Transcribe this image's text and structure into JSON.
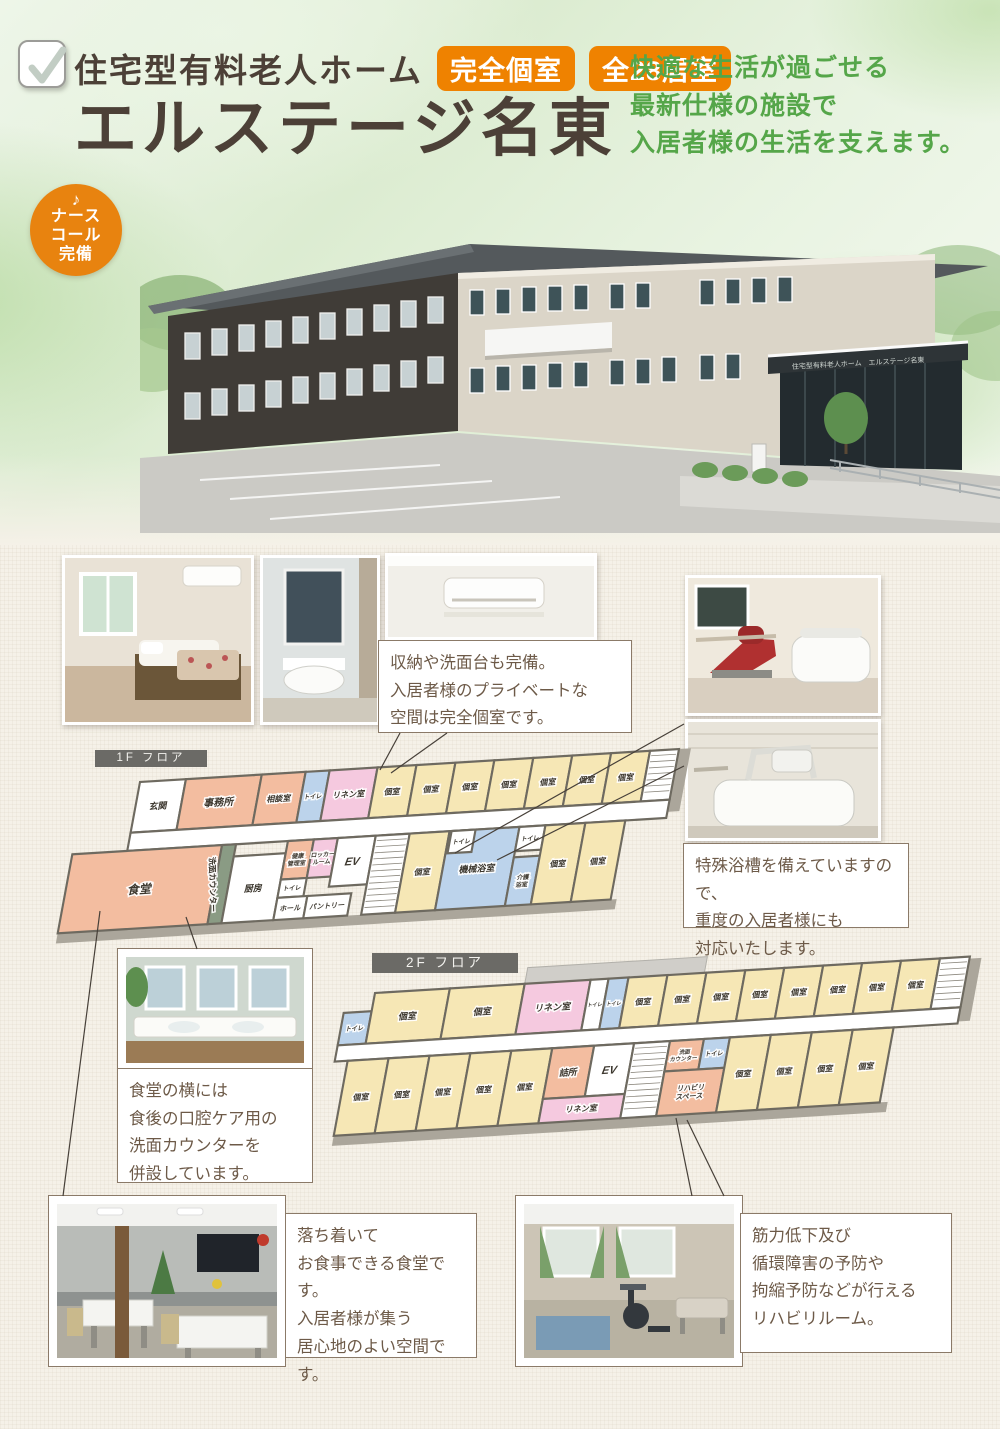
{
  "header": {
    "category": "住宅型有料老人ホーム",
    "badge1": "完全個室",
    "badge2": "全28居室",
    "title": "エルステージ名東",
    "tagline": [
      "快適な生活が過ごせる",
      "最新仕様の施設で",
      "入居者様の生活を支えます。"
    ],
    "nurse_note": "♪",
    "nurse_lines": [
      "ナース",
      "コール",
      "完備"
    ]
  },
  "building": {
    "sign": "住宅型有料老人ホーム　エルステージ名東"
  },
  "callouts": {
    "private_room": [
      "収納や洗面台も完備。",
      "入居者様のプライベートな",
      "空間は完全個室です。"
    ],
    "special_bath": [
      "特殊浴槽を備えていますので、",
      "重度の入居者様にも",
      "対応いたします。"
    ],
    "wash_counter": [
      "食堂の横には",
      "食後の口腔ケア用の",
      "洗面カウンターを",
      "併設しています。"
    ],
    "dining": [
      "落ち着いて",
      "お食事できる食堂です。",
      "入居者様が集う",
      "居心地のよい空間です。"
    ],
    "rehab": [
      "筋力低下及び",
      "循環障害の予防や",
      "拘縮予防などが行える",
      "リハビリルーム。"
    ]
  },
  "floors": [
    {
      "label": "1F フロア",
      "shadows": [
        {
          "x": -55,
          "y": 146,
          "w": 560,
          "h": 10
        },
        {
          "x": 540,
          "y": 0,
          "w": 12,
          "h": 62
        }
      ],
      "rooms": [
        {
          "label": "玄関",
          "x": 0,
          "y": 0,
          "w": 46,
          "h": 50,
          "f": "white",
          "fs": 9
        },
        {
          "label": "事務所",
          "x": 46,
          "y": 0,
          "w": 76,
          "h": 50,
          "f": "salmon",
          "fs": 10
        },
        {
          "label": "相談室",
          "x": 122,
          "y": 0,
          "w": 44,
          "h": 50,
          "f": "salmon",
          "fs": 8
        },
        {
          "label": "トイレ",
          "x": 166,
          "y": 0,
          "w": 24,
          "h": 50,
          "f": "blue",
          "fs": 6
        },
        {
          "label": "リネン室",
          "x": 190,
          "y": 0,
          "w": 48,
          "h": 50,
          "f": "pink",
          "fs": 8
        },
        {
          "label": "個室",
          "x": 238,
          "y": 0,
          "w": 39,
          "h": 50,
          "f": "cream",
          "fs": 8
        },
        {
          "label": "個室",
          "x": 277,
          "y": 0,
          "w": 39,
          "h": 50,
          "f": "cream",
          "fs": 8
        },
        {
          "label": "個室",
          "x": 316,
          "y": 0,
          "w": 39,
          "h": 50,
          "f": "cream",
          "fs": 8
        },
        {
          "label": "個室",
          "x": 355,
          "y": 0,
          "w": 39,
          "h": 50,
          "f": "cream",
          "fs": 8
        },
        {
          "label": "個室",
          "x": 394,
          "y": 0,
          "w": 39,
          "h": 50,
          "f": "cream",
          "fs": 8
        },
        {
          "label": "個室",
          "x": 433,
          "y": 0,
          "w": 39,
          "h": 50,
          "f": "cream",
          "fs": 8
        },
        {
          "label": "個室",
          "x": 472,
          "y": 0,
          "w": 39,
          "h": 50,
          "f": "cream",
          "fs": 8
        },
        {
          "label": "",
          "x": 511,
          "y": 0,
          "w": 29,
          "h": 50,
          "f": "stairs"
        },
        {
          "label": "",
          "x": 0,
          "y": 50,
          "w": 540,
          "h": 18,
          "f": "white"
        },
        {
          "label": "食堂",
          "x": -55,
          "y": 68,
          "w": 150,
          "h": 78,
          "f": "salmon",
          "fs": 12
        },
        {
          "label": "洗面カウンター",
          "x": 95,
          "y": 68,
          "w": 14,
          "h": 78,
          "f": "green",
          "fs": 8,
          "vert": true
        },
        {
          "label": "厨房",
          "x": 109,
          "y": 80,
          "w": 52,
          "h": 66,
          "f": "white",
          "fs": 9
        },
        {
          "label": "健康\n管理室",
          "x": 161,
          "y": 68,
          "w": 26,
          "h": 38,
          "f": "salmon",
          "fs": 6
        },
        {
          "label": "ロッカー\nルーム",
          "x": 187,
          "y": 68,
          "w": 24,
          "h": 38,
          "f": "pink",
          "fs": 6
        },
        {
          "label": "EV",
          "x": 211,
          "y": 68,
          "w": 38,
          "h": 48,
          "f": "white",
          "fs": 11
        },
        {
          "label": "トイレ",
          "x": 161,
          "y": 106,
          "w": 26,
          "h": 18,
          "f": "white",
          "fs": 6
        },
        {
          "label": "ホール",
          "x": 161,
          "y": 124,
          "w": 30,
          "h": 22,
          "f": "white",
          "fs": 7
        },
        {
          "label": "パントリー",
          "x": 191,
          "y": 124,
          "w": 44,
          "h": 22,
          "f": "white",
          "fs": 7
        },
        {
          "label": "",
          "x": 249,
          "y": 68,
          "w": 34,
          "h": 78,
          "f": "stairs"
        },
        {
          "label": "個室",
          "x": 283,
          "y": 68,
          "w": 40,
          "h": 78,
          "f": "cream",
          "fs": 8
        },
        {
          "label": "機械浴室",
          "x": 323,
          "y": 68,
          "w": 70,
          "h": 78,
          "f": "blue",
          "fs": 9
        },
        {
          "label": "トイレ",
          "x": 325,
          "y": 68,
          "w": 24,
          "h": 22,
          "f": "white",
          "fs": 6
        },
        {
          "label": "トイレ",
          "x": 393,
          "y": 68,
          "w": 26,
          "h": 24,
          "f": "white",
          "fs": 6
        },
        {
          "label": "介護\n浴室",
          "x": 393,
          "y": 98,
          "w": 26,
          "h": 48,
          "f": "blue",
          "fs": 6
        },
        {
          "label": "個室",
          "x": 419,
          "y": 68,
          "w": 40,
          "h": 78,
          "f": "cream",
          "fs": 8
        },
        {
          "label": "個室",
          "x": 459,
          "y": 68,
          "w": 40,
          "h": 78,
          "f": "cream",
          "fs": 8
        }
      ]
    },
    {
      "label": "2F フロア",
      "shadows": [
        {
          "x": -15,
          "y": 140,
          "w": 555,
          "h": 10
        },
        {
          "x": 596,
          "y": 2,
          "w": 12,
          "h": 62
        }
      ],
      "rooms": [
        {
          "label": "",
          "x": 150,
          "y": -16,
          "w": 180,
          "h": 16,
          "f": "balcony"
        },
        {
          "label": "トイレ",
          "x": -28,
          "y": 18,
          "w": 28,
          "h": 32,
          "f": "blue",
          "fs": 6
        },
        {
          "label": "個室",
          "x": 0,
          "y": 0,
          "w": 75,
          "h": 50,
          "f": "cream",
          "fs": 9
        },
        {
          "label": "個室",
          "x": 75,
          "y": 0,
          "w": 75,
          "h": 50,
          "f": "cream",
          "fs": 9
        },
        {
          "label": "リネン室",
          "x": 150,
          "y": 0,
          "w": 66,
          "h": 50,
          "f": "pink",
          "fs": 9
        },
        {
          "label": "トイレ",
          "x": 216,
          "y": 0,
          "w": 18,
          "h": 50,
          "f": "white",
          "fs": 5
        },
        {
          "label": "トイレ",
          "x": 234,
          "y": 0,
          "w": 20,
          "h": 50,
          "f": "blue",
          "fs": 5
        },
        {
          "label": "個室",
          "x": 254,
          "y": 0,
          "w": 39,
          "h": 50,
          "f": "cream",
          "fs": 8
        },
        {
          "label": "個室",
          "x": 293,
          "y": 0,
          "w": 39,
          "h": 50,
          "f": "cream",
          "fs": 8
        },
        {
          "label": "個室",
          "x": 332,
          "y": 0,
          "w": 39,
          "h": 50,
          "f": "cream",
          "fs": 8
        },
        {
          "label": "個室",
          "x": 371,
          "y": 0,
          "w": 39,
          "h": 50,
          "f": "cream",
          "fs": 8
        },
        {
          "label": "個室",
          "x": 410,
          "y": 0,
          "w": 39,
          "h": 50,
          "f": "cream",
          "fs": 8
        },
        {
          "label": "個室",
          "x": 449,
          "y": 0,
          "w": 39,
          "h": 50,
          "f": "cream",
          "fs": 8
        },
        {
          "label": "個室",
          "x": 488,
          "y": 0,
          "w": 39,
          "h": 50,
          "f": "cream",
          "fs": 8
        },
        {
          "label": "個室",
          "x": 527,
          "y": 0,
          "w": 39,
          "h": 50,
          "f": "cream",
          "fs": 8
        },
        {
          "label": "",
          "x": 566,
          "y": 0,
          "w": 30,
          "h": 50,
          "f": "stairs"
        },
        {
          "label": "",
          "x": -28,
          "y": 50,
          "w": 624,
          "h": 16,
          "f": "white"
        },
        {
          "label": "個室",
          "x": -15,
          "y": 66,
          "w": 41,
          "h": 74,
          "f": "cream",
          "fs": 8
        },
        {
          "label": "個室",
          "x": 26,
          "y": 66,
          "w": 41,
          "h": 74,
          "f": "cream",
          "fs": 8
        },
        {
          "label": "個室",
          "x": 67,
          "y": 66,
          "w": 41,
          "h": 74,
          "f": "cream",
          "fs": 8
        },
        {
          "label": "個室",
          "x": 108,
          "y": 66,
          "w": 41,
          "h": 74,
          "f": "cream",
          "fs": 8
        },
        {
          "label": "個室",
          "x": 149,
          "y": 66,
          "w": 41,
          "h": 74,
          "f": "cream",
          "fs": 8
        },
        {
          "label": "詰所",
          "x": 190,
          "y": 66,
          "w": 42,
          "h": 50,
          "f": "salmon",
          "fs": 9
        },
        {
          "label": "EV",
          "x": 232,
          "y": 66,
          "w": 40,
          "h": 50,
          "f": "white",
          "fs": 11
        },
        {
          "label": "リネン室",
          "x": 190,
          "y": 116,
          "w": 82,
          "h": 24,
          "f": "pink",
          "fs": 8
        },
        {
          "label": "",
          "x": 272,
          "y": 66,
          "w": 36,
          "h": 74,
          "f": "stairs"
        },
        {
          "label": "洗面\nカウンター",
          "x": 308,
          "y": 66,
          "w": 34,
          "h": 30,
          "f": "salmon",
          "fs": 5.5
        },
        {
          "label": "トイレ",
          "x": 342,
          "y": 66,
          "w": 26,
          "h": 30,
          "f": "blue",
          "fs": 6
        },
        {
          "label": "リハビリ\nスペース",
          "x": 308,
          "y": 96,
          "w": 60,
          "h": 44,
          "f": "salmon",
          "fs": 7
        },
        {
          "label": "個室",
          "x": 368,
          "y": 66,
          "w": 41,
          "h": 74,
          "f": "cream",
          "fs": 8
        },
        {
          "label": "個室",
          "x": 409,
          "y": 66,
          "w": 41,
          "h": 74,
          "f": "cream",
          "fs": 8
        },
        {
          "label": "個室",
          "x": 450,
          "y": 66,
          "w": 41,
          "h": 74,
          "f": "cream",
          "fs": 8
        },
        {
          "label": "個室",
          "x": 491,
          "y": 66,
          "w": 41,
          "h": 74,
          "f": "cream",
          "fs": 8
        }
      ]
    }
  ],
  "colors": {
    "accent_orange": "#ef8200",
    "green_text": "#55a649",
    "brown_text": "#4c4037",
    "room_cream": "#f6e7b5",
    "room_salmon": "#f3bda0",
    "room_pink": "#f5c9df",
    "room_blue": "#bcd3eb"
  }
}
